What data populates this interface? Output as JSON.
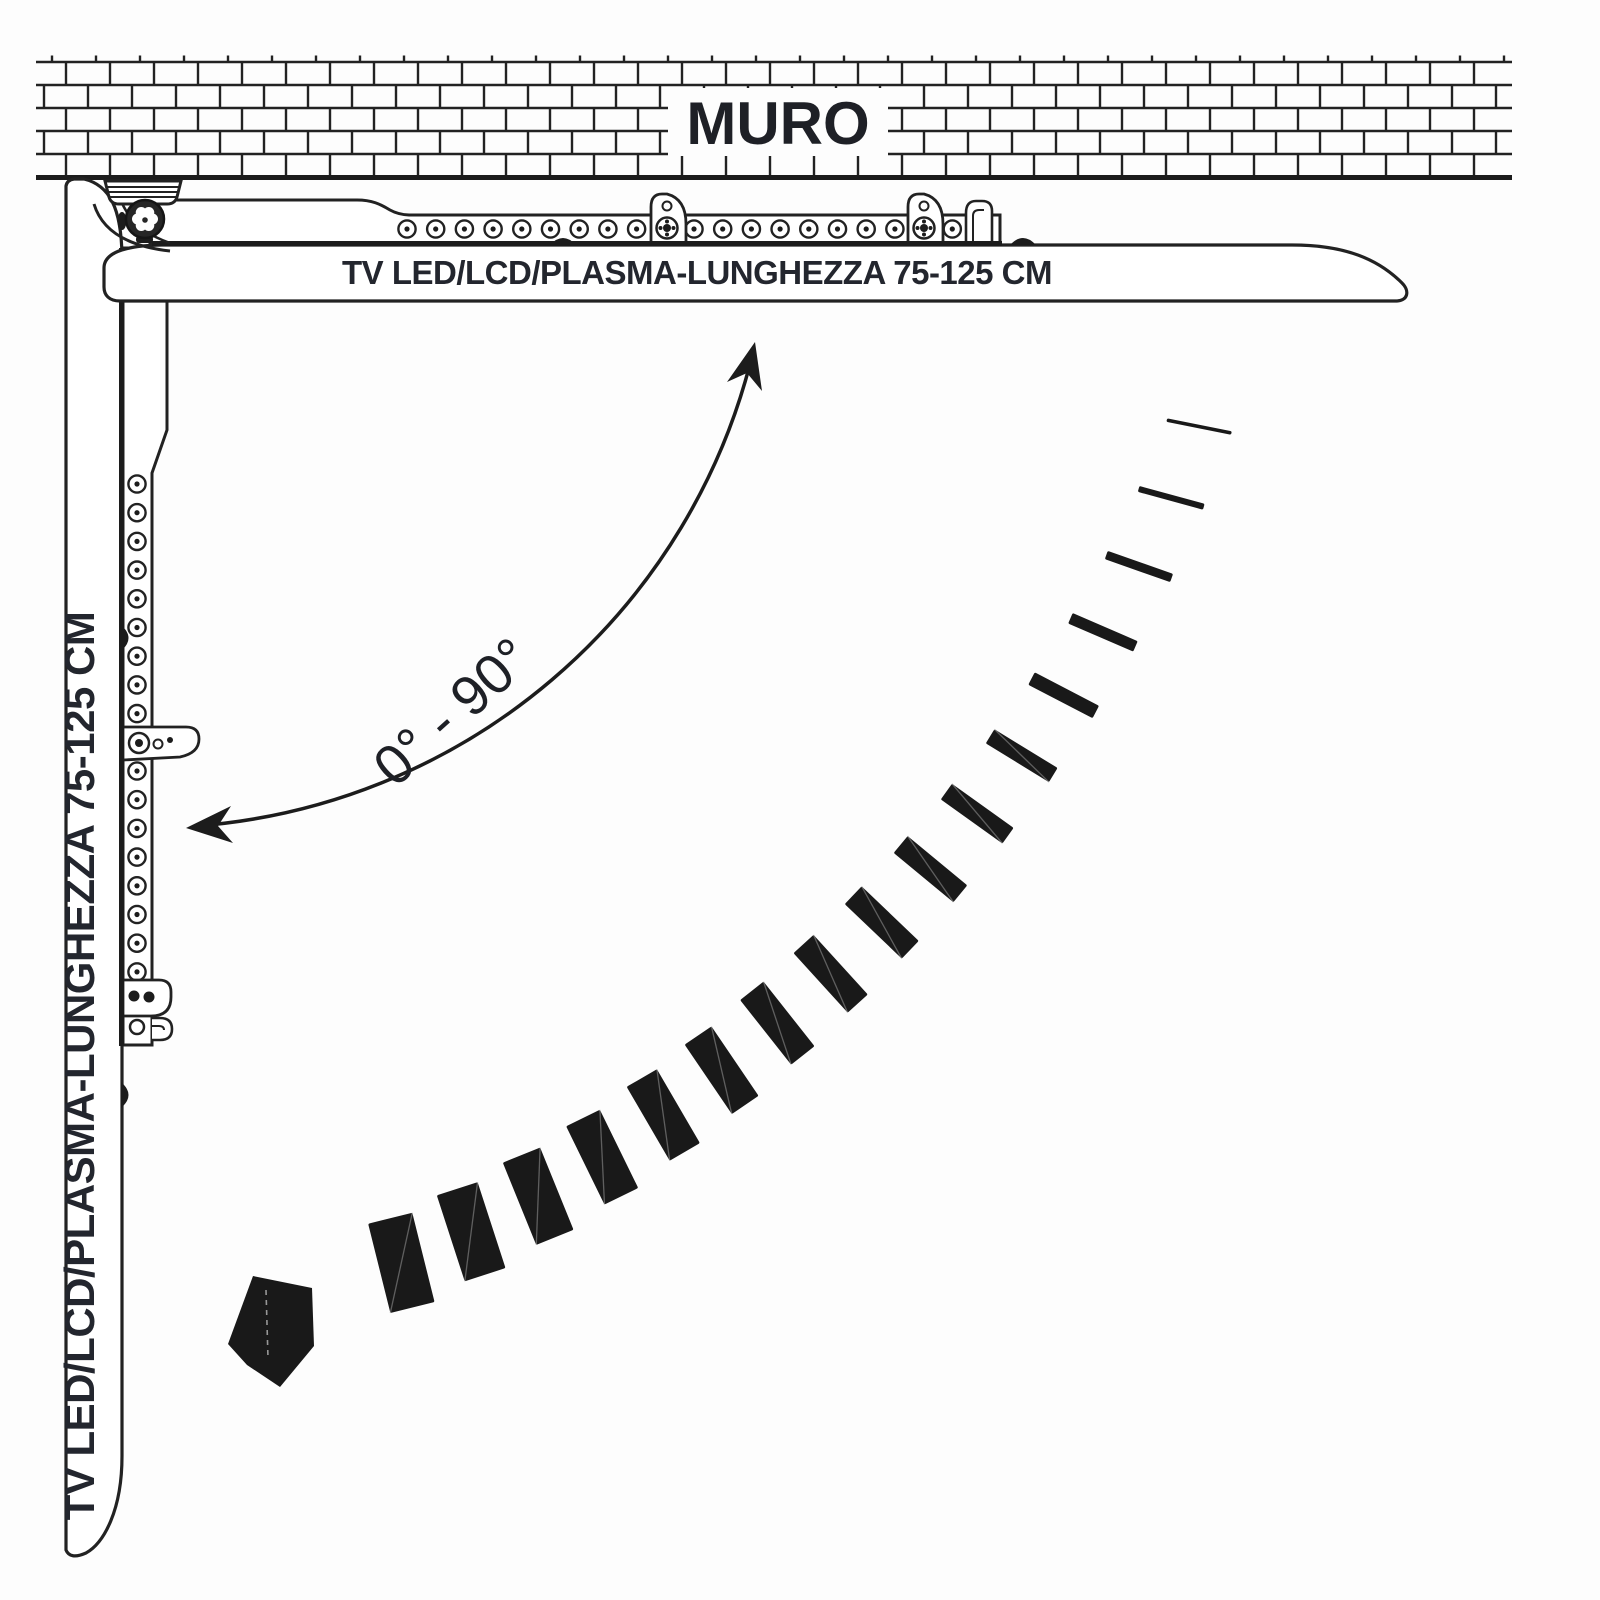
{
  "wall": {
    "label": "MURO"
  },
  "tv_horizontal": {
    "label": "TV LED/LCD/PLASMA-LUNGHEZZA 75-125 CM"
  },
  "tv_vertical": {
    "label": "TV LED/LCD/PLASMA-LUNGHEZZA 75-125 CM"
  },
  "rotation": {
    "angle_range_label": "0° - 90°",
    "min_deg": 0,
    "max_deg": 90
  },
  "swing_trail": {
    "segment_count": 17
  },
  "icons": {
    "rotation_arc": "curved-double-headed-arrow",
    "swing_arrow": "folded-arrow-pointing-down-left",
    "pivot_hinge": "knurled-hinge-knob"
  },
  "colors": {
    "ink": "#1c1c1c",
    "line": "#222222",
    "text_ink": "#23262e",
    "background": "#fdfdfd"
  }
}
